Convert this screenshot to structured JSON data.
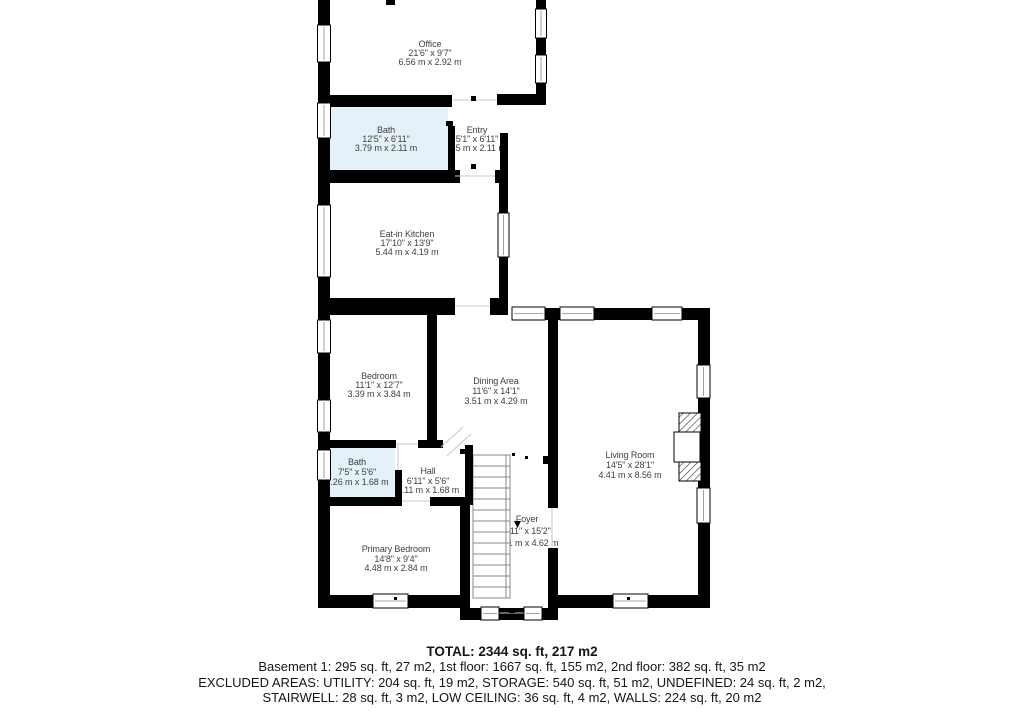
{
  "rooms": {
    "office": {
      "name": "Office",
      "imperial": "21'6\" x 9'7\"",
      "metric": "6.56 m x 2.92 m"
    },
    "bath_upper": {
      "name": "Bath",
      "imperial": "12'5\" x 6'11\"",
      "metric": "3.79 m x 2.11 m",
      "highlight": "#e4f1f9"
    },
    "entry": {
      "name": "Entry",
      "imperial": "5'1\" x 6'11\"",
      "metric": ".55 m x 2.11 m"
    },
    "kitchen": {
      "name": "Eat-in Kitchen",
      "imperial": "17'10\" x 13'9\"",
      "metric": "5.44 m x 4.19 m"
    },
    "bedroom": {
      "name": "Bedroom",
      "imperial": "11'1\" x 12'7\"",
      "metric": "3.39 m x 3.84 m"
    },
    "dining": {
      "name": "Dining Area",
      "imperial": "11'6\" x 14'1\"",
      "metric": "3.51 m x 4.29 m"
    },
    "living": {
      "name": "Living Room",
      "imperial": "14'5\" x 28'1\"",
      "metric": "4.41 m x 8.56 m"
    },
    "bath_lower": {
      "name": "Bath",
      "imperial": "7'5\" x 5'6\"",
      "metric": "2.26 m x 1.68 m",
      "highlight": "#e4f1f9"
    },
    "hall": {
      "name": "Hall",
      "imperial": "6'11\" x 5'6\"",
      "metric": "2.11 m x 1.68 m"
    },
    "foyer": {
      "name": "Foyer",
      "imperial": "7'11\" x 15'2\"",
      "metric": "2.41 m x 4.62 m"
    },
    "primary_bedroom": {
      "name": "Primary Bedroom",
      "imperial": "14'8\" x 9'4\"",
      "metric": "4.48 m x 2.84 m"
    }
  },
  "summary": {
    "total": "TOTAL: 2344 sq. ft, 217 m2",
    "floors": "Basement 1: 295 sq. ft, 27 m2, 1st floor: 1667 sq. ft, 155 m2, 2nd floor: 382 sq. ft, 35 m2",
    "excluded_1": "EXCLUDED AREAS: UTILITY: 204 sq. ft, 19 m2, STORAGE: 540 sq. ft, 51 m2, UNDEFINED: 24 sq. ft, 2 m2,",
    "excluded_2": "STAIRWELL: 28 sq. ft, 3 m2, LOW CEILING: 36 sq. ft, 4 m2, WALLS: 224 sq. ft, 20 m2"
  },
  "colors": {
    "wall": "#000000",
    "bath_fill": "#e4f1f9",
    "room_label_text": "#3f3f3f",
    "summary_text": "#161616"
  }
}
